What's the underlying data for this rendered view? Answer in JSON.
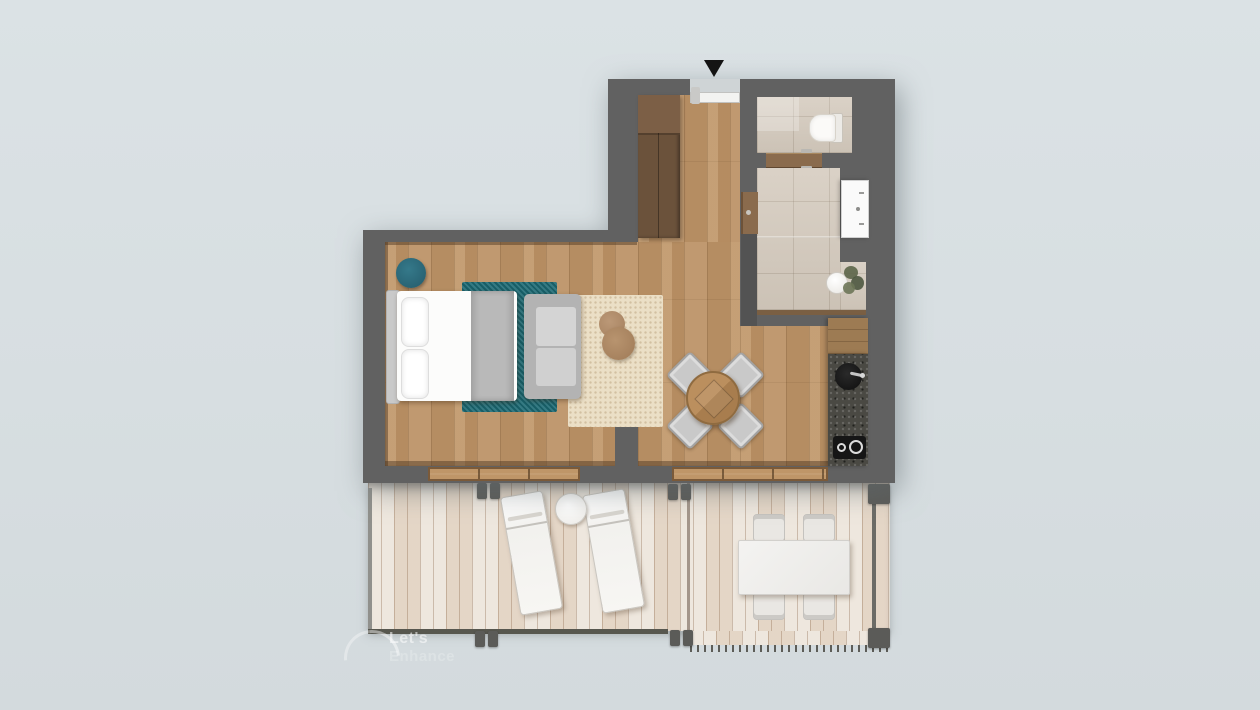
{
  "scene": {
    "type": "apartment floor plan, top-down 3D render",
    "background_color": "#d9e0e3",
    "wall_color": "#616161",
    "wood_floor_color": "#bd9468",
    "balcony_deck_color": "#e8ded1",
    "bathroom_tile_color": "#d4cabd",
    "kitchen_counter_color": "#4a4943",
    "accent_teal": "#1e6b75",
    "rug_beige_color": "#ebdfc6",
    "door_wood_color": "#8a6b4d"
  },
  "entrance": {
    "marker": "down-arrow",
    "marker_color": "#141414"
  },
  "furniture": {
    "hall": [
      "wardrobe",
      "entry-door"
    ],
    "bathroom": [
      "toilet",
      "wc-door",
      "vanity-sink",
      "stool",
      "plant"
    ],
    "bedroom_living": [
      "teal-pouf",
      "double-bed",
      "teal-rug",
      "sofa",
      "beige-rug",
      "coffee-table"
    ],
    "dining": [
      "round-dining-table",
      "four-chairs"
    ],
    "kitchen": [
      "counter",
      "round-sink",
      "two-burner-cooktop"
    ],
    "balcony": [
      "sun-lounger",
      "sun-lounger",
      "side-table",
      "outdoor-table",
      "four-outdoor-chairs"
    ]
  },
  "watermark": {
    "line1": "Let's",
    "line2": "Enhance"
  }
}
